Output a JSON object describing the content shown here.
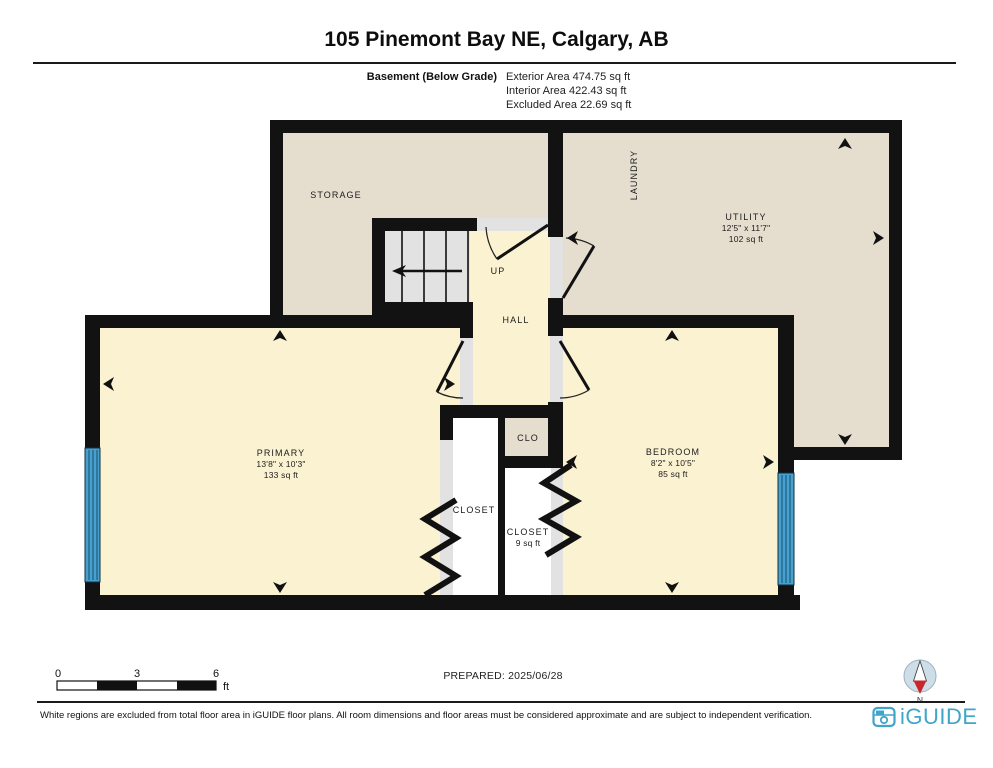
{
  "header": {
    "title": "105 Pinemont Bay NE, Calgary, AB",
    "floor_label": "Basement (Below Grade)",
    "area_lines": [
      "Exterior Area 474.75 sq ft",
      "Interior Area 422.43 sq ft",
      "Excluded Area 22.69 sq ft"
    ]
  },
  "floor_plan": {
    "rooms": {
      "storage": {
        "name": "STORAGE"
      },
      "laundry": {
        "name": "LAUNDRY"
      },
      "utility": {
        "name": "UTILITY",
        "dimensions": "12'5\" x 11'7\"",
        "area": "102 sq ft"
      },
      "stairs": {
        "label": "UP"
      },
      "hall": {
        "name": "HALL"
      },
      "primary": {
        "name": "PRIMARY",
        "dimensions": "13'8\" x 10'3\"",
        "area": "133 sq ft"
      },
      "bedroom": {
        "name": "BEDROOM",
        "dimensions": "8'2\" x 10'5\"",
        "area": "85 sq ft"
      },
      "clo": {
        "name": "CLO"
      },
      "closet_primary": {
        "name": "CLOSET"
      },
      "closet_bedroom": {
        "name": "CLOSET",
        "area": "9 sq ft"
      }
    },
    "compass_label": "N"
  },
  "scale_bar": {
    "ticks": [
      "0",
      "3",
      "6"
    ],
    "unit": "ft"
  },
  "footer": {
    "prepared": "PREPARED: 2025/06/28",
    "disclaimer": "White regions are excluded from total floor area in iGUIDE floor plans. All room dimensions and floor areas must be considered approximate and are subject to independent verification.",
    "brand": "iGUIDE"
  },
  "colors": {
    "wall": "#121212",
    "room_tan": "#e5decf",
    "room_cream": "#fbf2d2",
    "stair_gray": "#e2e2e2",
    "excluded_white": "#ffffff",
    "window_blue": "#4aa0cc",
    "brand_teal": "#3fa5c9",
    "compass_red": "#c9252c"
  }
}
